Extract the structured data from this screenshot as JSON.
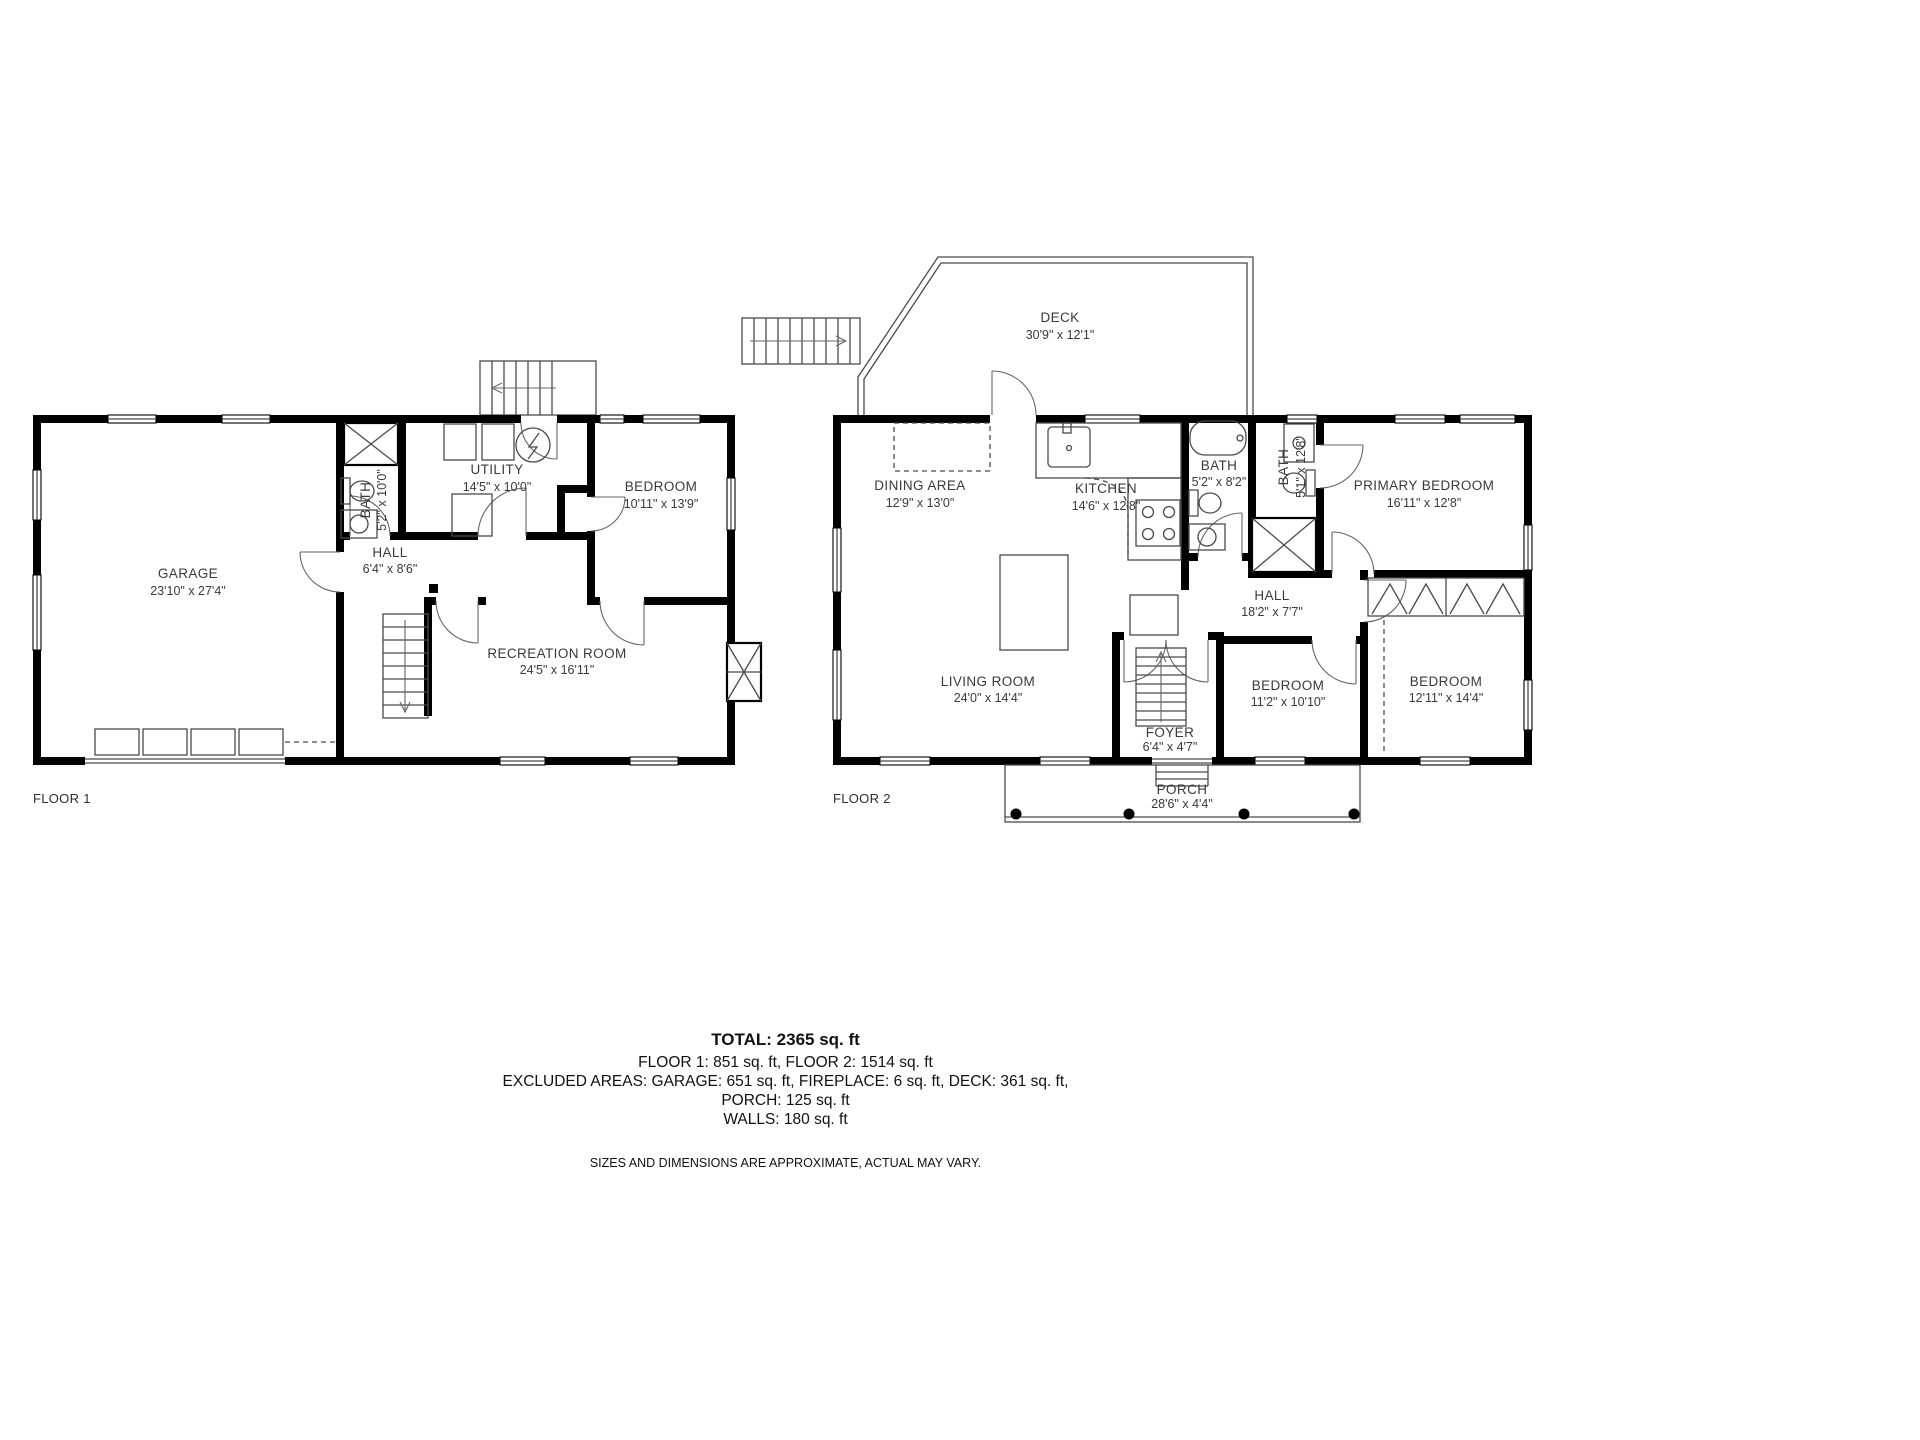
{
  "floor1": {
    "tag": "FLOOR 1",
    "rooms": {
      "garage": {
        "name": "GARAGE",
        "dims": "23'10\" x 27'4\""
      },
      "bath": {
        "name": "BATH",
        "dims": "5'2\" x 10'0\""
      },
      "utility": {
        "name": "UTILITY",
        "dims": "14'5\" x 10'0\""
      },
      "hall": {
        "name": "HALL",
        "dims": "6'4\" x 8'6\""
      },
      "bedroom": {
        "name": "BEDROOM",
        "dims": "10'11\" x 13'9\""
      },
      "recreation": {
        "name": "RECREATION ROOM",
        "dims": "24'5\" x 16'11\""
      }
    }
  },
  "floor2": {
    "tag": "FLOOR 2",
    "rooms": {
      "deck": {
        "name": "DECK",
        "dims": "30'9\" x 12'1\""
      },
      "dining": {
        "name": "DINING AREA",
        "dims": "12'9\" x 13'0\""
      },
      "kitchen": {
        "name": "KITCHEN",
        "dims": "14'6\" x 12'8\""
      },
      "bath1": {
        "name": "BATH",
        "dims": "5'2\" x 8'2\""
      },
      "bath2": {
        "name": "BATH",
        "dims": "5'1\" x 12'8\""
      },
      "primary": {
        "name": "PRIMARY BEDROOM",
        "dims": "16'11\" x 12'8\""
      },
      "hall": {
        "name": "HALL",
        "dims": "18'2\" x 7'7\""
      },
      "living": {
        "name": "LIVING ROOM",
        "dims": "24'0\" x 14'4\""
      },
      "foyer": {
        "name": "FOYER",
        "dims": "6'4\" x 4'7\""
      },
      "bedroom2": {
        "name": "BEDROOM",
        "dims": "11'2\" x 10'10\""
      },
      "bedroom3": {
        "name": "BEDROOM",
        "dims": "12'11\" x 14'4\""
      },
      "porch": {
        "name": "PORCH",
        "dims": "28'6\" x 4'4\""
      }
    }
  },
  "summary": {
    "total": "TOTAL: 2365 sq. ft",
    "floors": "FLOOR 1: 851 sq. ft, FLOOR 2: 1514 sq. ft",
    "excluded": "EXCLUDED AREAS: GARAGE: 651 sq. ft, FIREPLACE: 6 sq. ft, DECK: 361 sq. ft,",
    "porch": "PORCH: 125 sq. ft",
    "walls": "WALLS: 180 sq. ft",
    "disclaimer": "SIZES AND DIMENSIONS ARE APPROXIMATE, ACTUAL MAY VARY."
  }
}
